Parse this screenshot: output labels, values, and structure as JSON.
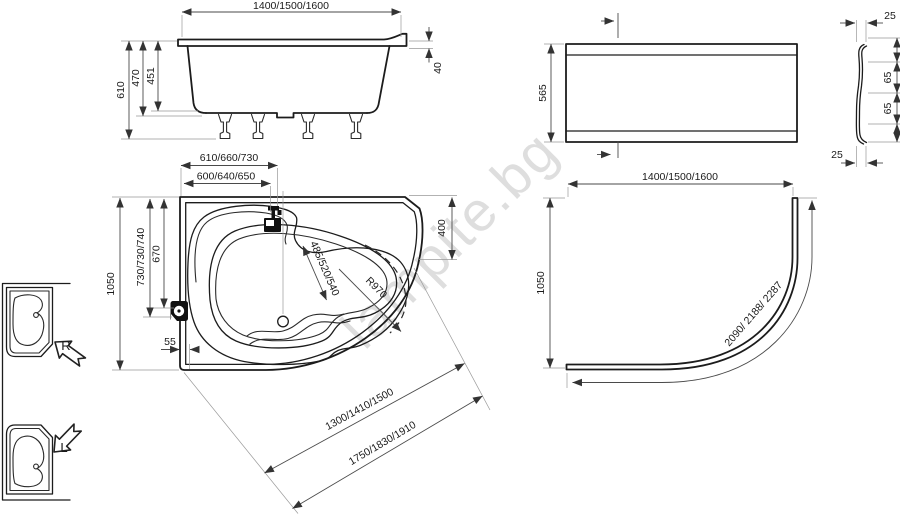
{
  "watermark": {
    "text": "lampite.bg"
  },
  "colors": {
    "line": "#1c1c1c",
    "dimension": "#4a4a4a",
    "extension": "#999999",
    "watermark": "#c9c9c9",
    "background": "#ffffff"
  },
  "side_view": {
    "length": "1400/1500/1600",
    "height_total": "610",
    "height_shell": "470",
    "height_inner": "451",
    "rim_drop": "40"
  },
  "front_panel": {
    "height": "565",
    "top_gap": "25",
    "offset_upper": "65",
    "offset_lower": "65",
    "bottom_gap": "25"
  },
  "top_view": {
    "width_tap_outer": "610/660/730",
    "width_tap": "600/640/650",
    "depth_left": "730/730/740",
    "depth_knob": "670",
    "width_total": "1050",
    "shell_offset": "55",
    "basin_width": "485/520/540",
    "radius": "R970",
    "corner_edge": "400",
    "diagonal_inner": "1300/1410/1500",
    "diagonal_outer": "1750/1830/1910"
  },
  "apron_view": {
    "length": "1400/1500/1600",
    "width": "1050",
    "arc_length": "2090/ 2188/ 2287"
  },
  "orientation": {
    "right_label": "R",
    "left_label": "L"
  }
}
